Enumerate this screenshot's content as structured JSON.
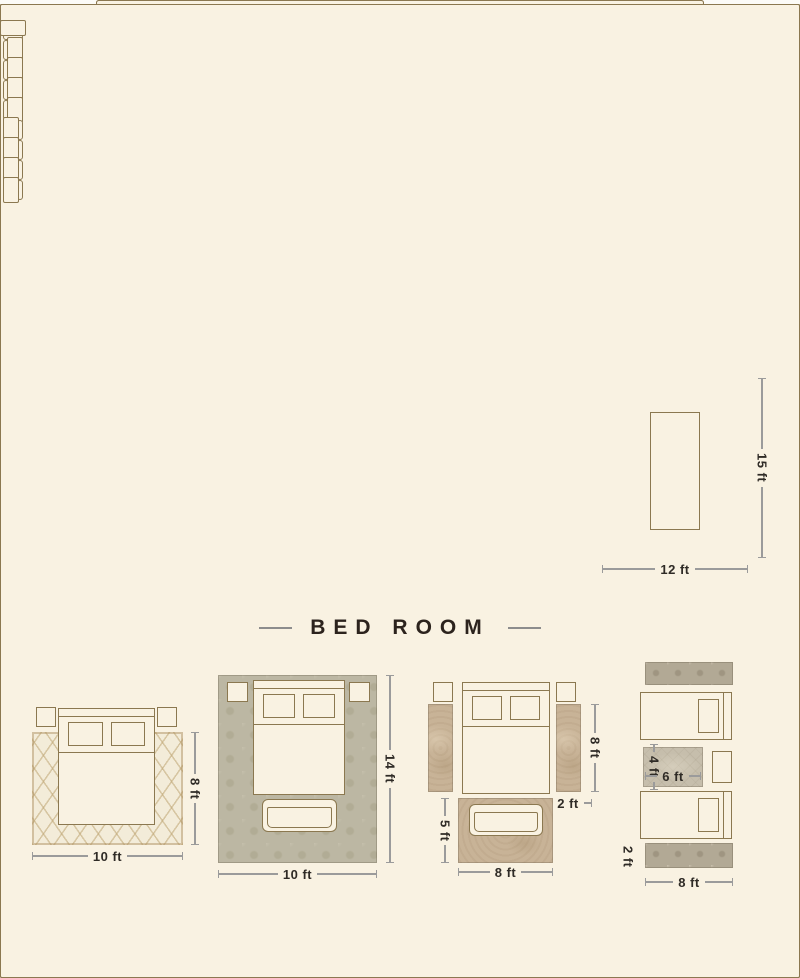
{
  "sections": {
    "living": {
      "title": "LIVING ROOM",
      "layouts": [
        {
          "width": "8 ft",
          "height": "5 ft"
        },
        {
          "width": "10 ft",
          "height": "8 ft"
        },
        {
          "width": "9 ft",
          "height": "12 ft"
        },
        {
          "width": "10 ft",
          "height": "14 ft"
        }
      ]
    },
    "dining": {
      "title": "DINING ROOM",
      "layouts": [
        {
          "width": "10 ft",
          "height": "8 ft"
        },
        {
          "width": "12 ft",
          "height": "9 ft"
        },
        {
          "width": "14 ft",
          "height": "10 ft"
        },
        {
          "width": "12 ft",
          "height": "15 ft"
        }
      ]
    },
    "bedroom": {
      "title": "BED ROOM",
      "layouts": [
        {
          "width": "10 ft",
          "height": "8 ft"
        },
        {
          "width": "10 ft",
          "height": "14 ft"
        },
        {
          "runner_length": "8 ft",
          "runner_width": "2 ft",
          "foot_height": "5 ft",
          "foot_width": "8 ft"
        },
        {
          "mid_height": "4 ft",
          "mid_width": "6 ft",
          "runner_width": "2 ft",
          "width": "8 ft"
        }
      ]
    }
  },
  "colors": {
    "background": "#fcfbf7",
    "furniture_fill": "#f9f2e2",
    "furniture_outline": "#8b7850",
    "title_text": "#2c231d",
    "dimension_text": "#2f2b26",
    "dimension_line": "#9b9b9b"
  }
}
